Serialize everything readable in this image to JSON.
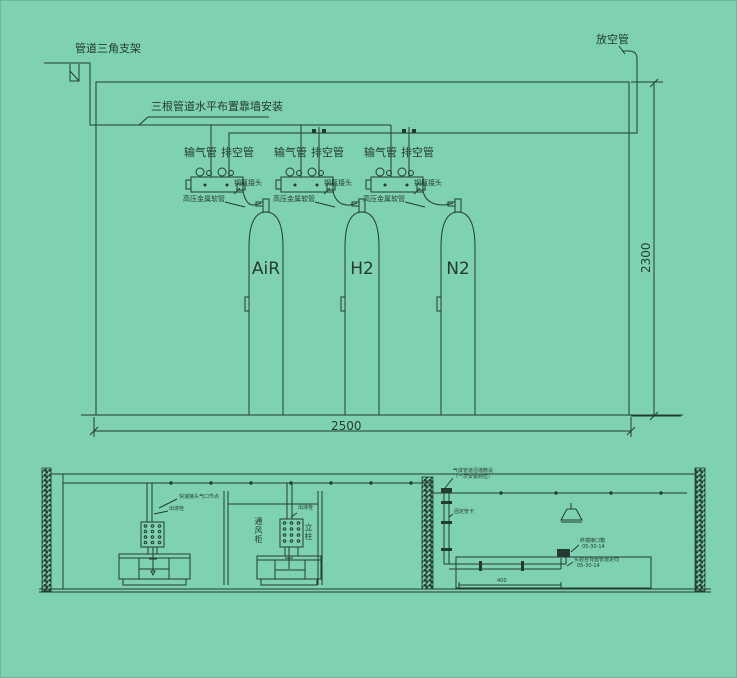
{
  "colors": {
    "background": "#7fd2b1",
    "ink": "#233b32"
  },
  "upper": {
    "bracket_label": "管道三角支架",
    "vent_stack_label": "放空管",
    "wall_note": "三根管道水平布置靠墙安装",
    "dim_width": "2500",
    "dim_height": "2300",
    "stations": [
      {
        "supply_label": "输气管",
        "vent_label": "排空管",
        "cylinder_connector_label": "钢瓶接头",
        "hose_label": "高压金属软管",
        "gas_label": "AiR"
      },
      {
        "supply_label": "输气管",
        "vent_label": "排空管",
        "cylinder_connector_label": "钢瓶接头",
        "hose_label": "高压金属软管",
        "gas_label": "H2"
      },
      {
        "supply_label": "输气管",
        "vent_label": "排空管",
        "cylinder_connector_label": "钢瓶接头",
        "hose_label": "高压金属软管",
        "gas_label": "N2"
      }
    ]
  },
  "lower": {
    "ceiling_note_line1": "气体管道沿墙敷设",
    "ceiling_note_line2": "（一次安装到位）",
    "quick_connect_note": "快速接头气口节点",
    "outlet_label_left": "出液栓",
    "outlet_label_mid": "出液栓",
    "fume_hood_label": "通风柜",
    "column_label": "立柱",
    "pipe_clamp_label": "固定管卡",
    "terminal_box_label": "终端接口箱",
    "terminal_box_code": "05-30-14",
    "bench_note": "实验台背面管道走向",
    "bench_note_code": "05-30-14",
    "small_dim": "400"
  }
}
